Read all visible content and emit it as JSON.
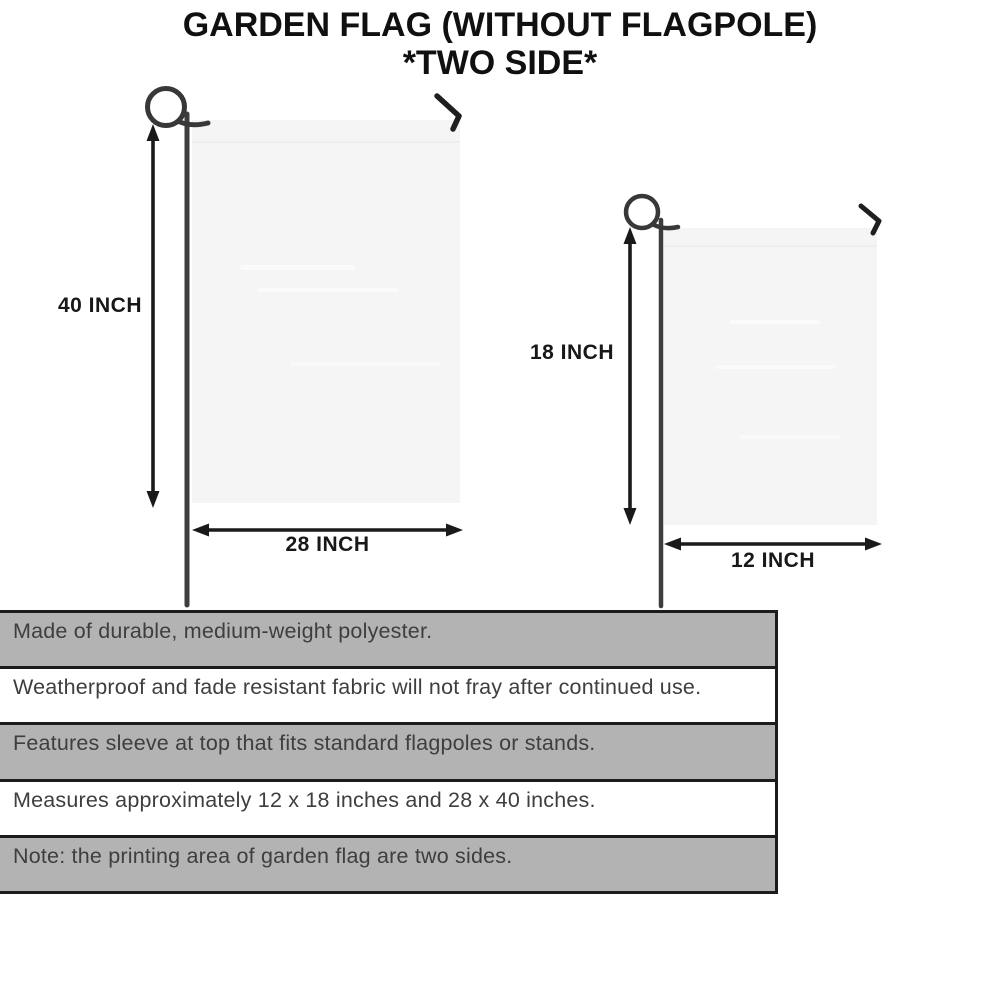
{
  "title": {
    "line1": "GARDEN FLAG (WITHOUT FLAGPOLE)",
    "line2": "*TWO SIDE*"
  },
  "diagram": {
    "large_flag": {
      "name": "garden flag 28 x 40 inches",
      "height_label": "40 INCH",
      "width_label": "28 INCH"
    },
    "small_flag": {
      "name": "garden flag 12 x 18 inches",
      "height_label": "18 INCH",
      "width_label": "12 INCH"
    },
    "icons": [
      "flagpole-loop-icon",
      "hanger-hook-icon",
      "dimension-arrow-icon"
    ]
  },
  "features": {
    "rows": [
      {
        "text": "Made of durable, medium-weight polyester.",
        "shaded": true
      },
      {
        "text": "Weatherproof and fade resistant fabric will not fray after continued use.",
        "shaded": false
      },
      {
        "text": "Features sleeve at top that fits standard flagpoles or stands.",
        "shaded": true
      },
      {
        "text": "Measures approximately 12 x 18 inches and 28 x 40 inches.",
        "shaded": false
      },
      {
        "text": "Note: the printing area of garden flag are two sides.",
        "shaded": true
      }
    ]
  },
  "colors": {
    "row_shaded": "#b3b3b3",
    "row_plain": "#ffffff",
    "table_border": "#1c1c1c",
    "flag_fill": "#f5f5f5",
    "pole": "#3d3d3d",
    "arrow": "#1a1a1a",
    "body_text": "#3e3e3e",
    "title_text": "#101010"
  }
}
